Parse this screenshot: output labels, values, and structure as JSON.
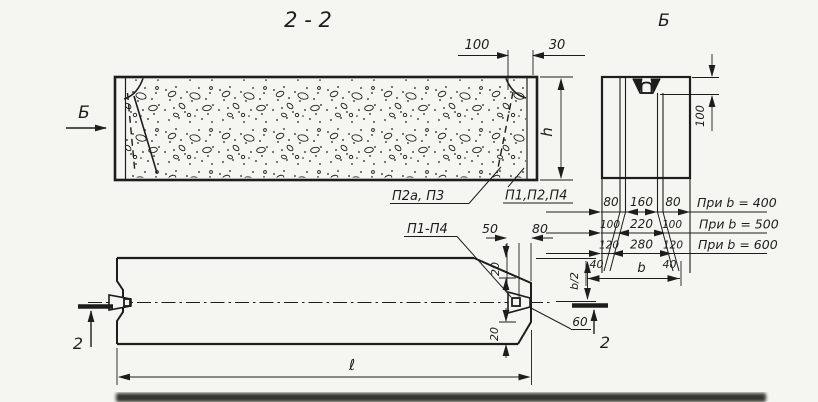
{
  "drawing": {
    "paper_color": "#f5f5f1",
    "ink_color": "#1d1d1b"
  },
  "section_view": {
    "title": "2 - 2",
    "view_arrow_label": "Б",
    "dim_recess": "100",
    "dim_edge_strip": "30",
    "dim_height": "h",
    "callout_top": "П2а, П3",
    "callout_bottom": "П1,П2,П4"
  },
  "end_view": {
    "title": "Б",
    "dim_recess_depth": "100",
    "rows": [
      {
        "left": "80",
        "center": "160",
        "right": "80",
        "note": "При b = 400"
      },
      {
        "left": "100",
        "center": "220",
        "right": "100",
        "note": "При b = 500"
      },
      {
        "left": "120",
        "center": "280",
        "right": "120",
        "note": "При b = 600"
      }
    ],
    "dim_bevel_left": "40",
    "dim_bevel_right": "40",
    "dim_width": "b"
  },
  "plan_view": {
    "callout": "П1-П4",
    "dim_key_depth": "50",
    "dim_key_offset": "80",
    "dim_chamfer_top": "20",
    "dim_chamfer_bottom": "20",
    "dim_key_height": "60",
    "dim_half_width": "b/2",
    "dim_length": "ℓ",
    "cut_label_left": "2",
    "cut_label_right": "2"
  }
}
